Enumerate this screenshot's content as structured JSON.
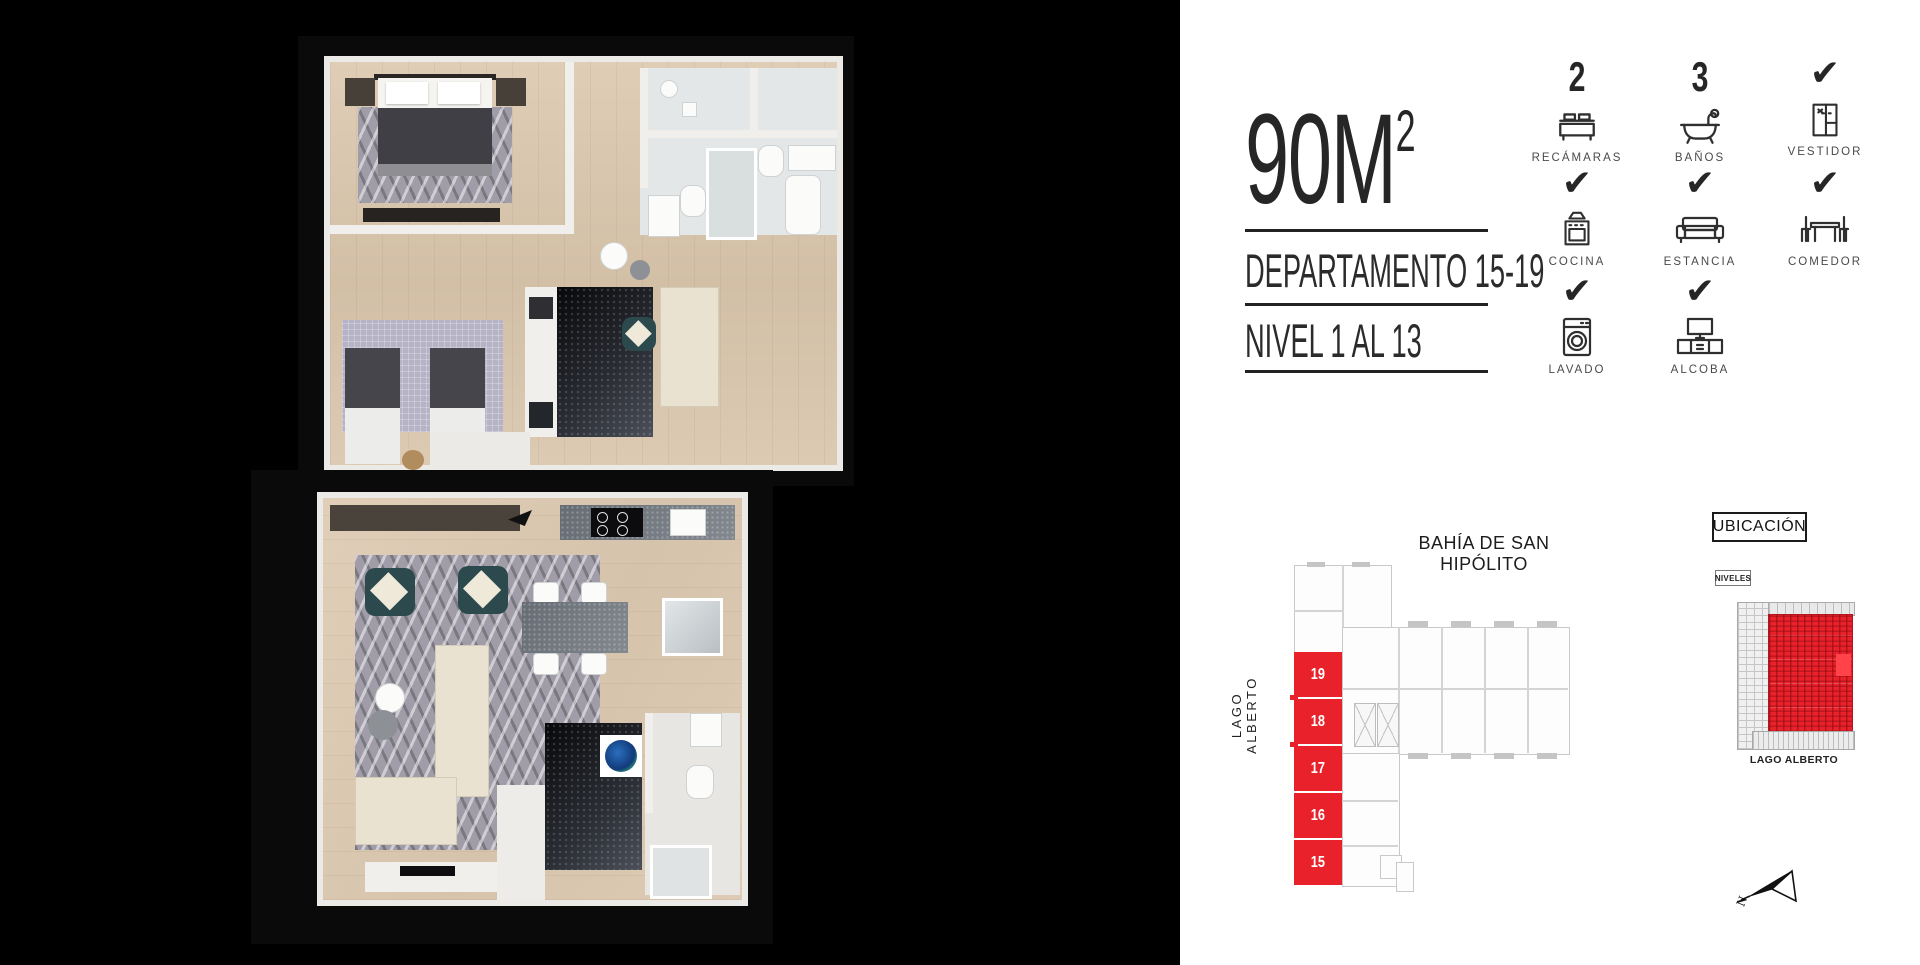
{
  "panel": {
    "area": "90M",
    "area_sup": "2",
    "department": "DEPARTAMENTO 15-19",
    "level": "NIVEL 1 AL 13",
    "features": [
      {
        "value": "2",
        "label": "RECÁMARAS",
        "icon": "bed"
      },
      {
        "value": "3",
        "label": "BAÑOS",
        "icon": "bathtub"
      },
      {
        "value": "✔",
        "label": "VESTIDOR",
        "icon": "wardrobe"
      },
      {
        "value": "✔",
        "label": "COCINA",
        "icon": "stove"
      },
      {
        "value": "✔",
        "label": "ESTANCIA",
        "icon": "sofa"
      },
      {
        "value": "✔",
        "label": "COMEDOR",
        "icon": "dining-table"
      },
      {
        "value": "✔",
        "label": "LAVADO",
        "icon": "washing-machine"
      },
      {
        "value": "✔",
        "label": "ALCOBA",
        "icon": "tv-console"
      }
    ]
  },
  "siteplan": {
    "street_top": "BAHÍA DE SAN HIPÓLITO",
    "street_left": "LAGO ALBERTO",
    "ubicacion_label": "UBICACIÓN",
    "niveles_label": "NIVELES",
    "units": [
      "19",
      "18",
      "17",
      "16",
      "15"
    ],
    "north_label": "N"
  },
  "elevation": {
    "caption": "LAGO ALBERTO"
  },
  "colors": {
    "highlight_red": "#E8212A",
    "ink": "#262626"
  }
}
